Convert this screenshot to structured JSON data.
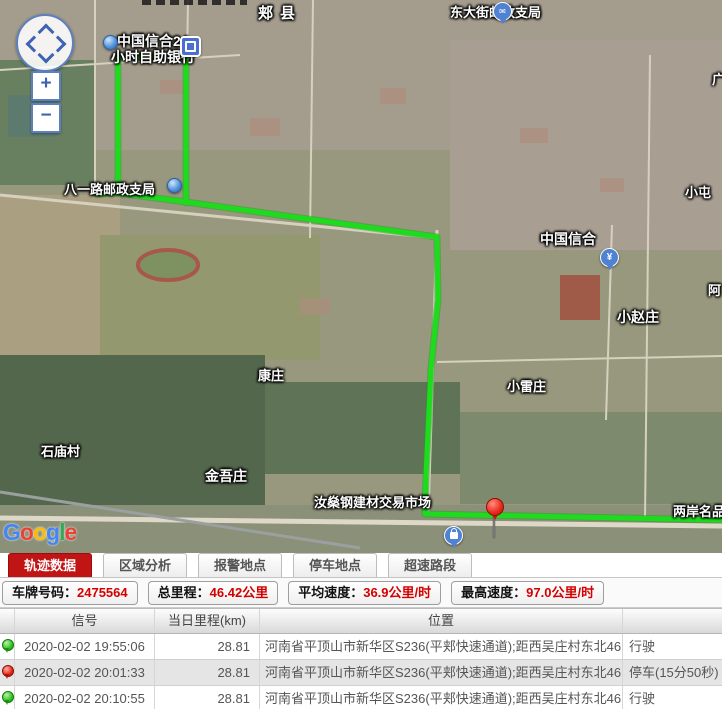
{
  "map": {
    "labels": [
      {
        "text": "郏县"
      },
      {
        "text": "东大街邮政支局"
      },
      {
        "text": "中国信合24"
      },
      {
        "text": "小时自助银行"
      },
      {
        "text": "八一路邮政支局"
      },
      {
        "text": "中国信合"
      },
      {
        "text": "小屯"
      },
      {
        "text": "小赵庄"
      },
      {
        "text": "康庄"
      },
      {
        "text": "小雷庄"
      },
      {
        "text": "石庙村"
      },
      {
        "text": "金吾庄"
      },
      {
        "text": "汝燊钢建材交易市场"
      },
      {
        "text": "两岸名品"
      },
      {
        "text": "阿"
      },
      {
        "text": "广"
      }
    ],
    "markers": {
      "yen_glyph": "¥"
    },
    "controls": {
      "zoom_in": "+",
      "zoom_out": "−"
    },
    "google": [
      "G",
      "o",
      "o",
      "g",
      "l",
      "e"
    ],
    "route_color": "#1edb1e"
  },
  "tabs": [
    {
      "label": "轨迹数据",
      "active": true
    },
    {
      "label": "区域分析",
      "active": false
    },
    {
      "label": "报警地点",
      "active": false
    },
    {
      "label": "停车地点",
      "active": false
    },
    {
      "label": "超速路段",
      "active": false
    }
  ],
  "stats": [
    {
      "label": "车牌号码：",
      "value": "2475564"
    },
    {
      "label": "总里程：",
      "value": "46.42公里"
    },
    {
      "label": "平均速度：",
      "value": "36.9公里/时"
    },
    {
      "label": "最高速度：",
      "value": "97.0公里/时"
    }
  ],
  "table": {
    "headers": {
      "signal": "信号",
      "mileage": "当日里程(km)",
      "location": "位置"
    },
    "rows": [
      {
        "pin": "green",
        "time": "2020-02-02 19:55:06",
        "mileage": "28.81",
        "location": "河南省平顶山市新华区S236(平郏快速通道);距西吴庄村东北46",
        "status": "行驶"
      },
      {
        "pin": "red",
        "time": "2020-02-02 20:01:33",
        "mileage": "28.81",
        "location": "河南省平顶山市新华区S236(平郏快速通道);距西吴庄村东北46",
        "status": "停车(15分50秒)"
      },
      {
        "pin": "green",
        "time": "2020-02-02 20:10:55",
        "mileage": "28.81",
        "location": "河南省平顶山市新华区S236(平郏快速通道);距西吴庄村东北46",
        "status": "行驶"
      },
      {
        "pin": "green"
      }
    ]
  }
}
